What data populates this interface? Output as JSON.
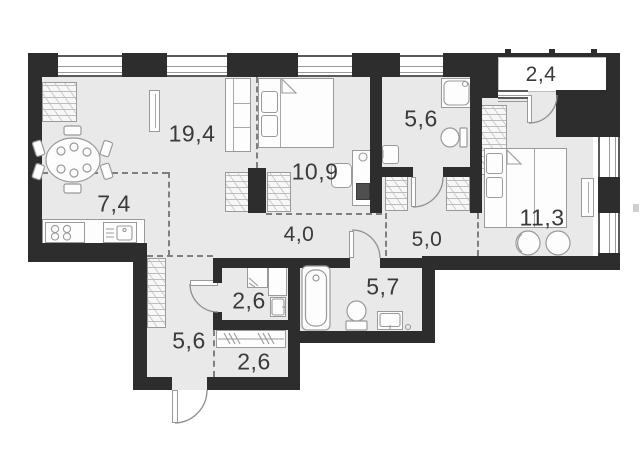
{
  "title": "apartment-floor-plan",
  "rooms": [
    {
      "name": "living-room",
      "area": "19,4"
    },
    {
      "name": "kitchen",
      "area": "7,4"
    },
    {
      "name": "sleeping-area",
      "area": "10,9"
    },
    {
      "name": "bathroom",
      "area": "5,6"
    },
    {
      "name": "balcony",
      "area": "2,4"
    },
    {
      "name": "bedroom",
      "area": "11,3"
    },
    {
      "name": "hallway-right",
      "area": "5,0"
    },
    {
      "name": "hallway-center",
      "area": "4,0"
    },
    {
      "name": "bathroom-2",
      "area": "5,7"
    },
    {
      "name": "entrance-hall",
      "area": "5,6"
    },
    {
      "name": "utility-room",
      "area": "2,6"
    },
    {
      "name": "wardrobe-room",
      "area": "2,6"
    }
  ],
  "colors": {
    "wall": "#2d2d2d",
    "floor": "#e9e9e9",
    "fixture_line": "#9a9a9a",
    "dashed_line": "#7f7f7f",
    "label_text": "#3a3a3a",
    "background": "#ffffff"
  }
}
